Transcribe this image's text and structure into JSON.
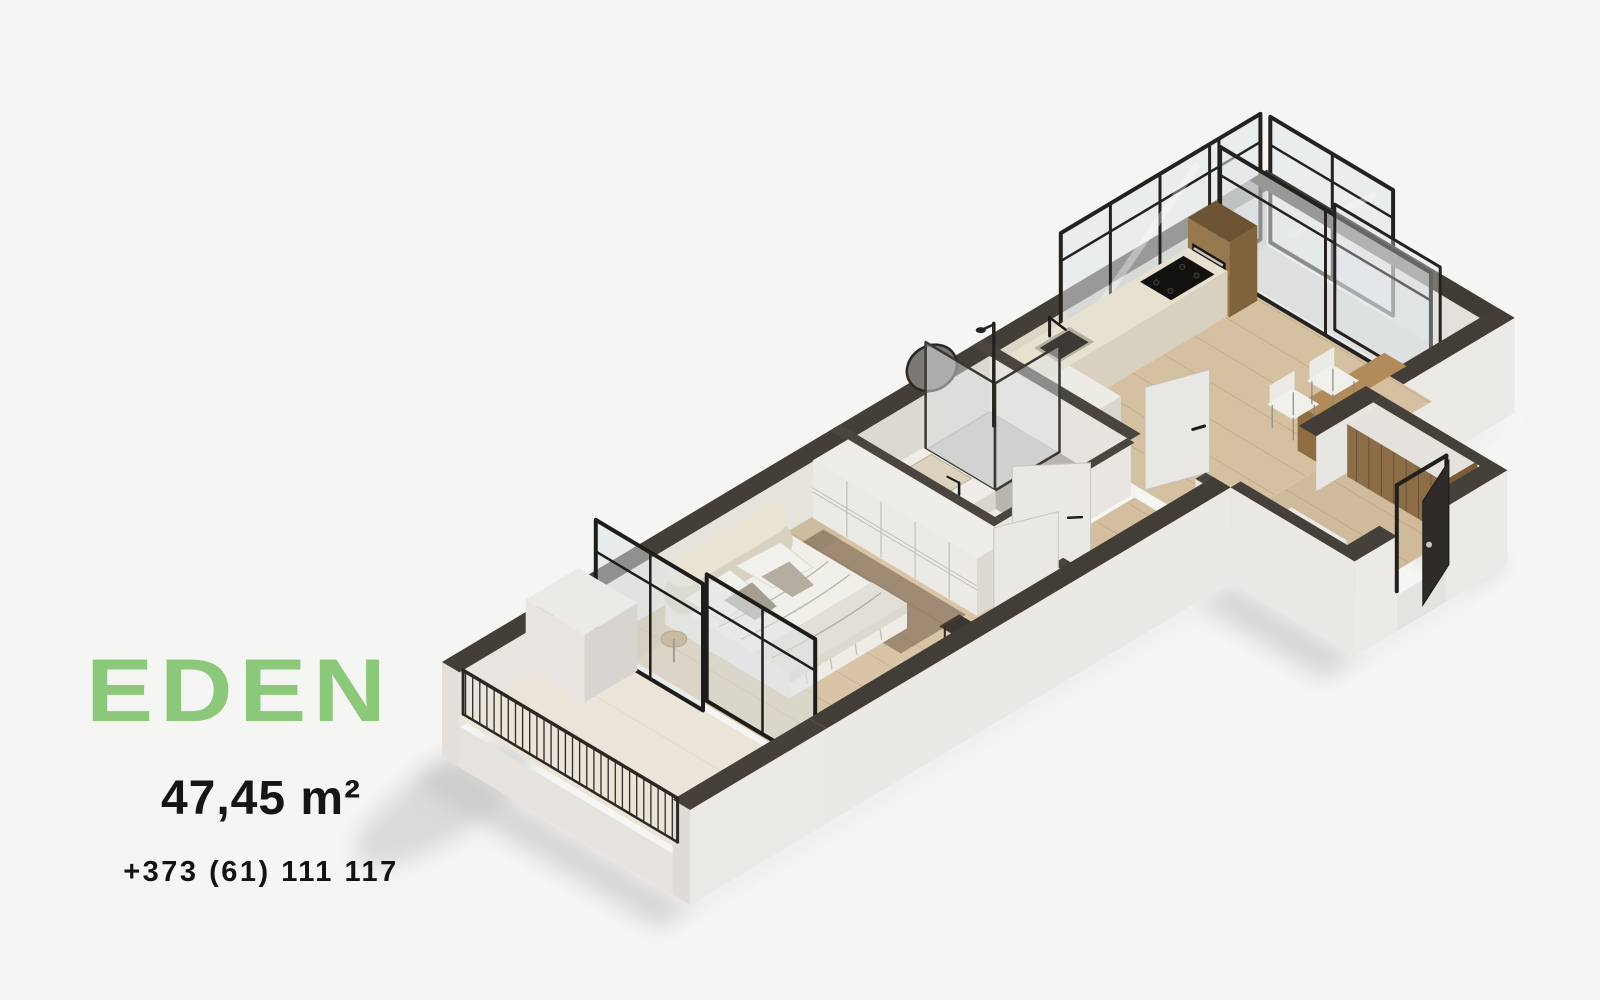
{
  "flyer": {
    "title": "EDEN",
    "area": "47,45 m²",
    "phone": "+373 (61) 111 117"
  },
  "colors": {
    "accent_green": "#8cc87a",
    "text_dark": "#151515",
    "background": "#f5f5f3",
    "wall_cut_top": "#433e38",
    "wood_floor": "#d5c1a2",
    "window_frame": "#24211e"
  }
}
